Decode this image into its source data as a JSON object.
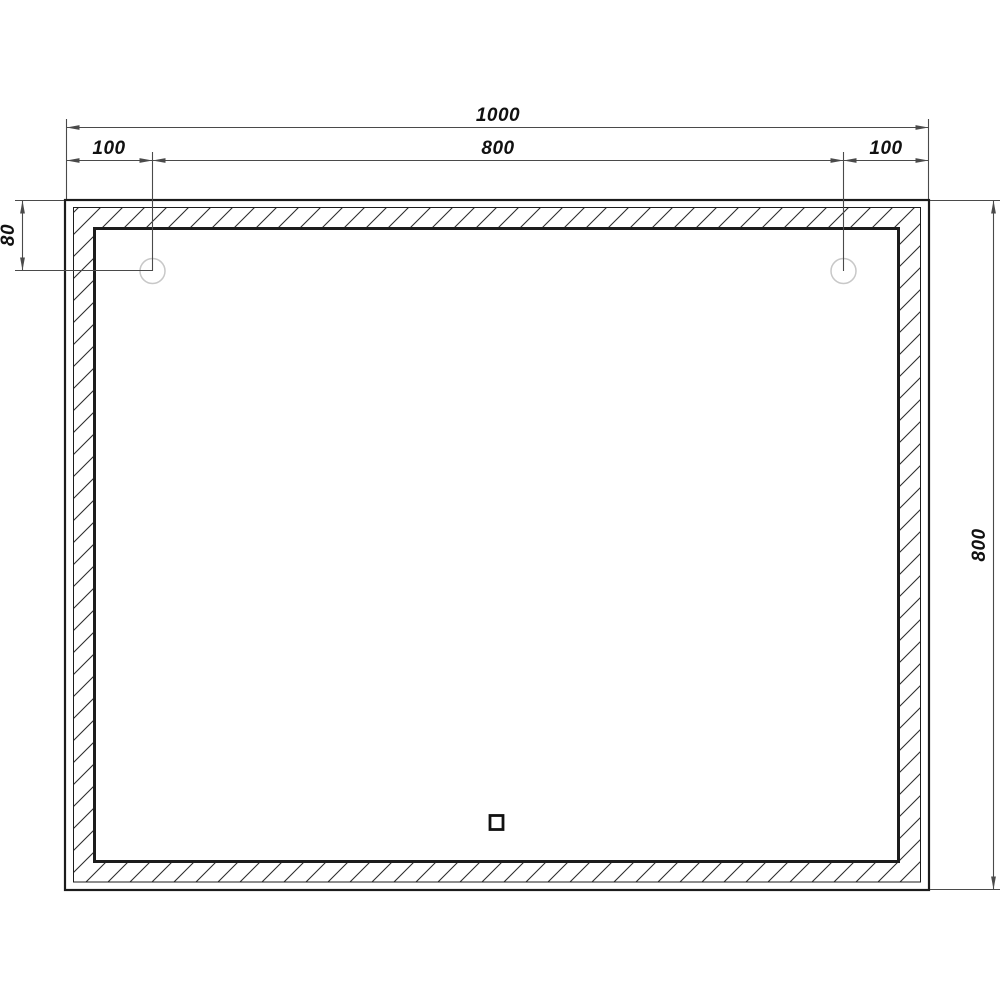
{
  "drawing": {
    "labels": {
      "width_total": "1000",
      "width_left_offset": "100",
      "width_center_span": "800",
      "width_right_offset": "100",
      "height_top_offset": "80",
      "height_total": "800"
    },
    "colors": {
      "background": "#ffffff",
      "outline": "#1c1c1c",
      "dimension": "#4a4a4a",
      "text": "#111111",
      "mount_circle": "#c8c8c8",
      "hatch": "#2e2e2e"
    },
    "features": {
      "left_mount_point": "mount-circle",
      "right_mount_point": "mount-circle",
      "touch_sensor": "sensor-square",
      "led_band": "hatched-frame"
    }
  }
}
